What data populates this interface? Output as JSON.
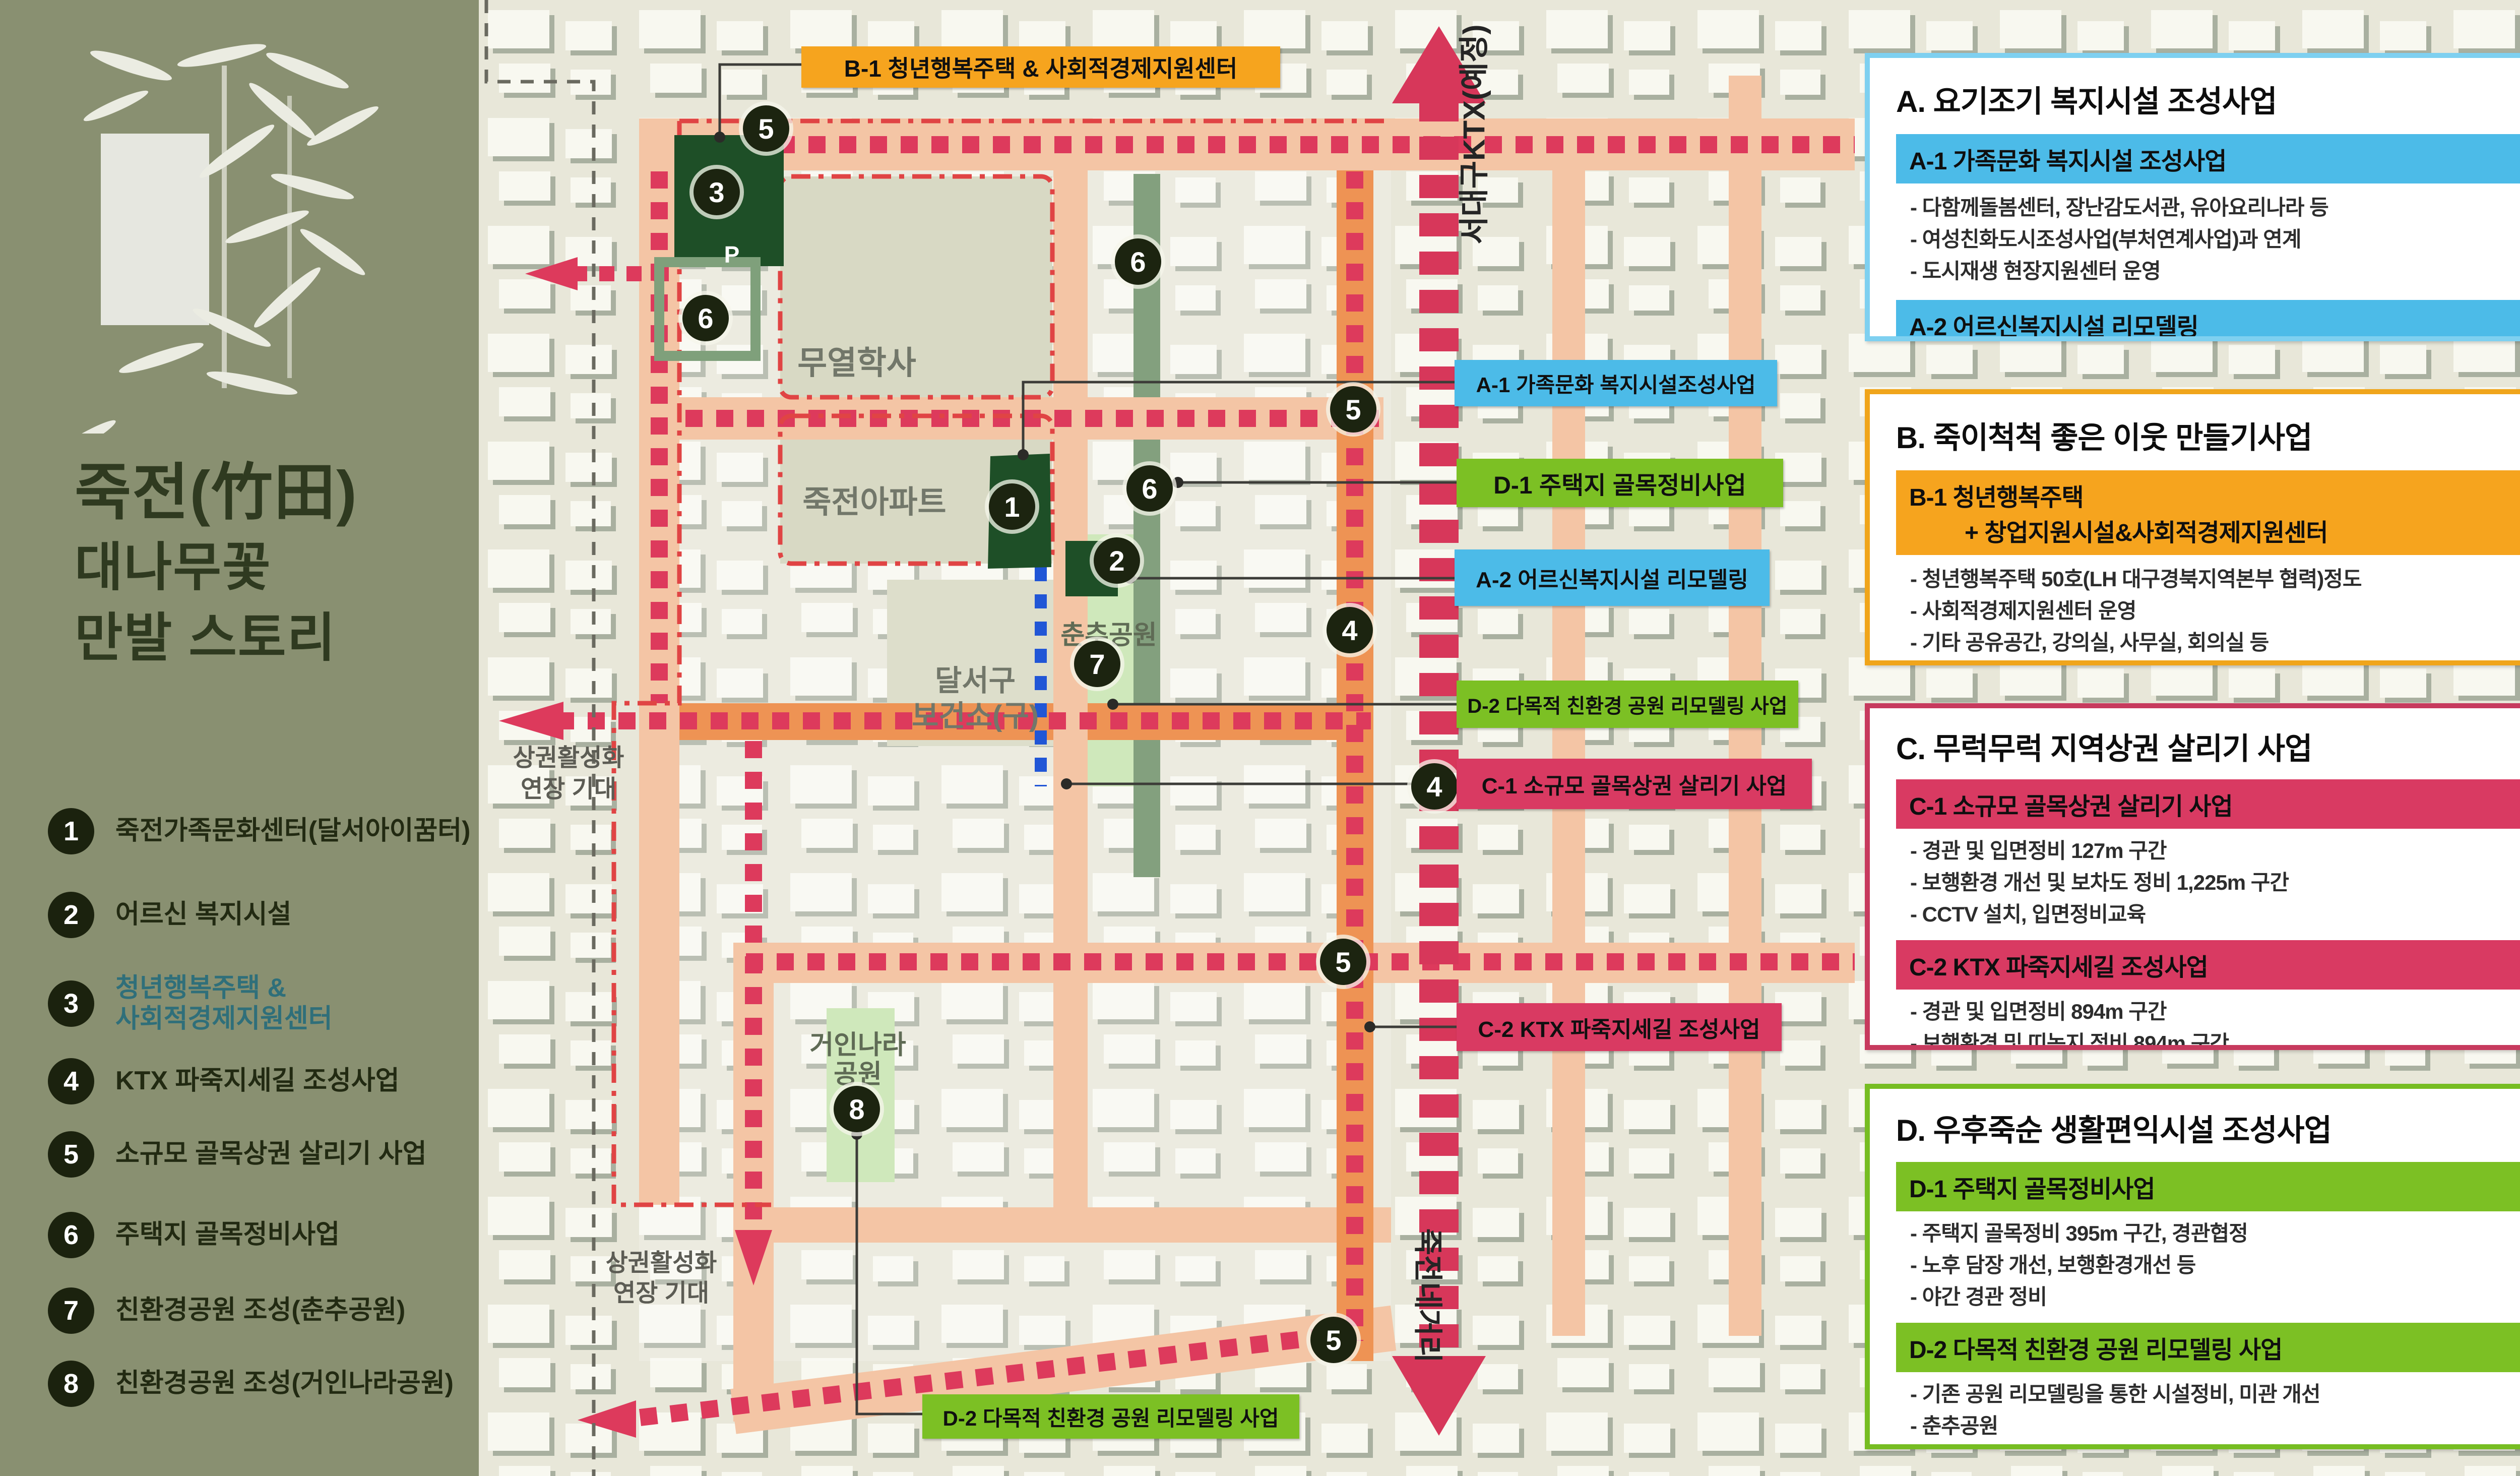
{
  "sidebar": {
    "title_lines": [
      "죽전(竹田)",
      "대나무꽃",
      "만발 스토리"
    ],
    "legend": [
      {
        "num": "1",
        "label": "죽전가족문화센터(달서아이꿈터)"
      },
      {
        "num": "2",
        "label": "어르신 복지시설"
      },
      {
        "num": "3",
        "label": "청년행복주택 &",
        "label2": "사회적경제지원센터"
      },
      {
        "num": "4",
        "label": "KTX 파죽지세길 조성사업"
      },
      {
        "num": "5",
        "label": "소규모 골목상권 살리기 사업"
      },
      {
        "num": "6",
        "label": "주택지 골목정비사업"
      },
      {
        "num": "7",
        "label": "친환경공원 조성(춘추공원)"
      },
      {
        "num": "8",
        "label": "친환경공원 조성(거인나라공원)"
      }
    ]
  },
  "map": {
    "markers": [
      "5",
      "3",
      "6",
      "6",
      "5",
      "1",
      "6",
      "2",
      "7",
      "4",
      "4",
      "5",
      "8",
      "5"
    ],
    "labels": {
      "muyeolhaksa": "무열학사",
      "jukjeon_apartment": "죽전아파트",
      "health_center_line1": "달서구",
      "health_center_line2": "보건소(구)",
      "chunchu_park": "춘추공원",
      "geoin_park_line1": "거인나라",
      "geoin_park_line2": "공원",
      "commerce_extension_line1": "상권활성화",
      "commerce_extension_line2": "연장 기대",
      "seodaegu_ktx": "서대구KTX(예정)",
      "jukjeon_intersection": "죽전네거리",
      "parking": "P"
    },
    "callouts": {
      "b1": "B-1 청년행복주택 & 사회적경제지원센터",
      "a1": "A-1 가족문화 복지시설조성사업",
      "d1": "D-1 주택지 골목정비사업",
      "a2": "A-2 어르신복지시설 리모델링",
      "d2_park": "D-2 다목적 친환경 공원 리모델링 사업",
      "c1": "C-1 소규모 골목상권 살리기 사업",
      "c2": "C-2 KTX 파죽지세길 조성사업",
      "d2_bottom": "D-2 다목적 친환경 공원 리모델링 사업"
    }
  },
  "panels": {
    "a": {
      "title": "A. 요기조기 복지시설 조성사업",
      "s1_header": "A-1 가족문화 복지시설 조성사업",
      "s1_bullets": [
        "- 다함께돌봄센터, 장난감도서관, 유아요리나라 등",
        "- 여성친화도시조성사업(부처연계사업)과 연계",
        "- 도시재생 현장지원센터 운영"
      ],
      "s2_header": "A-2 어르신복지시설 리모델링",
      "s2_bullets": [
        "- 경로당 및 치매예방교실(지자체연계사업) 운영"
      ]
    },
    "b": {
      "title": "B. 죽이척척 좋은 이웃 만들기사업",
      "s1_header_line1": "B-1 청년행복주택",
      "s1_header_line2": "+ 창업지원시설&사회적경제지원센터",
      "s1_bullets": [
        "- 청년행복주택 50호(LH 대구경북지역본부 협력)정도",
        "- 사회적경제지원센터 운영",
        "- 기타 공유공간, 강의실, 사무실, 회의실 등"
      ]
    },
    "c": {
      "title": "C. 무럭무럭 지역상권 살리기 사업",
      "s1_header": "C-1 소규모 골목상권 살리기 사업",
      "s1_bullets": [
        "- 경관 및 입면정비 127m 구간",
        "- 보행환경 개선 및 보차도 정비 1,225m 구간",
        "- CCTV 설치, 입면정비교육"
      ],
      "s2_header": "C-2 KTX 파죽지세길 조성사업",
      "s2_bullets": [
        "- 경관 및 입면정비 894m 구간",
        "- 보행환경 및 띠녹지 정비 894m 구간",
        "- 입면정비교육"
      ]
    },
    "d": {
      "title": "D. 우후죽순 생활편익시설 조성사업",
      "s1_header": "D-1 주택지 골목정비사업",
      "s1_bullets": [
        "- 주택지 골목정비 395m 구간, 경관협정",
        "- 노후 담장 개선, 보행환경개선 등",
        "- 야간 경관 정비"
      ],
      "s2_header": "D-2 다목적 친환경 공원 리모델링 사업",
      "s2_bullets": [
        "- 기존 공원 리모델링을 통한 시설정비, 미관 개선",
        "- 춘추공원",
        "- 거인나라공원"
      ]
    }
  },
  "colors": {
    "category_a_blue": "#4cbbe8",
    "category_b_orange": "#f6a41e",
    "category_c_crimson": "#d93a62",
    "category_d_green": "#7cc024",
    "road_salmon": "#f4c5a5",
    "road_orange": "#ee9354",
    "dash_red": "#dd3a5c",
    "dark_green_building": "#1e4f27",
    "park_green": "#cfe8bb",
    "sidebar_olive": "#899071"
  }
}
